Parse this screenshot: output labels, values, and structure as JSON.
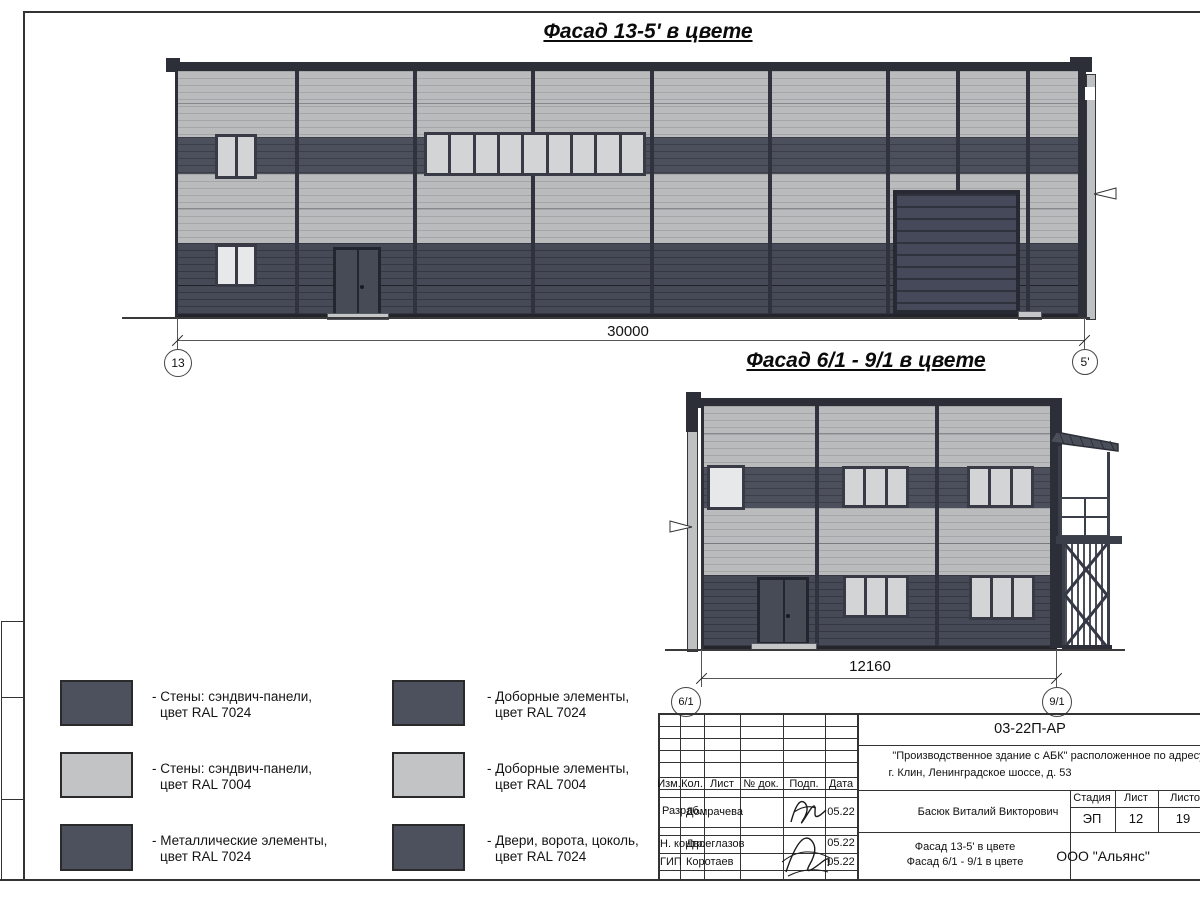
{
  "titles": {
    "facade1": "Фасад 13-5' в цвете",
    "facade2": "Фасад 6/1 - 9/1 в цвете"
  },
  "facade1": {
    "dimension": "30000",
    "axis_left": "13",
    "axis_right": "5'"
  },
  "facade2": {
    "dimension": "12160",
    "axis_left": "6/1",
    "axis_right": "9/1"
  },
  "legend": {
    "items": [
      {
        "swatch": "dark",
        "line1": "- Стены: сэндвич-панели,",
        "line2": "цвет RAL 7024"
      },
      {
        "swatch": "light",
        "line1": "- Стены: сэндвич-панели,",
        "line2": "цвет RAL 7004"
      },
      {
        "swatch": "dark",
        "line1": "- Металлические элементы,",
        "line2": "цвет RAL 7024"
      },
      {
        "swatch": "dark",
        "line1": "- Доборные элементы,",
        "line2": "цвет RAL 7024"
      },
      {
        "swatch": "light",
        "line1": "- Доборные элементы,",
        "line2": "цвет RAL 7004"
      },
      {
        "swatch": "dark",
        "line1": "- Двери, ворота, цоколь,",
        "line2": "цвет RAL 7024"
      }
    ]
  },
  "titleblock": {
    "doc_number": "03-22П-АР",
    "project_line1": "\"Производственное здание с АБК\" расположенное по адресу:",
    "project_line2": "г. Клин, Ленинградское шоссе, д. 53",
    "header": [
      "Изм.",
      "Кол.",
      "Лист",
      "№ док.",
      "Подп.",
      "Дата"
    ],
    "rows": [
      {
        "role": "Разраб.",
        "name": "Домрачева",
        "date": "05.22"
      },
      {
        "role": "Н. контр.",
        "name": "Двоеглазов",
        "date": "05.22"
      },
      {
        "role": "ГИП",
        "name": "Коротаев",
        "date": "05.22"
      }
    ],
    "approver": "Басюк Виталий Викторович",
    "stage_label": "Стадия",
    "sheet_label": "Лист",
    "sheets_label": "Листов",
    "stage": "ЭП",
    "sheet": "12",
    "sheets": "19",
    "drawing_title_line1": "Фасад 13-5' в цвете",
    "drawing_title_line2": "Фасад 6/1 - 9/1 в цвете",
    "company": "ООО \"Альянс\""
  },
  "colors": {
    "ral7024": "#4c505c",
    "ral7004": "#b9bbbd",
    "trim": "#2c2f38"
  }
}
